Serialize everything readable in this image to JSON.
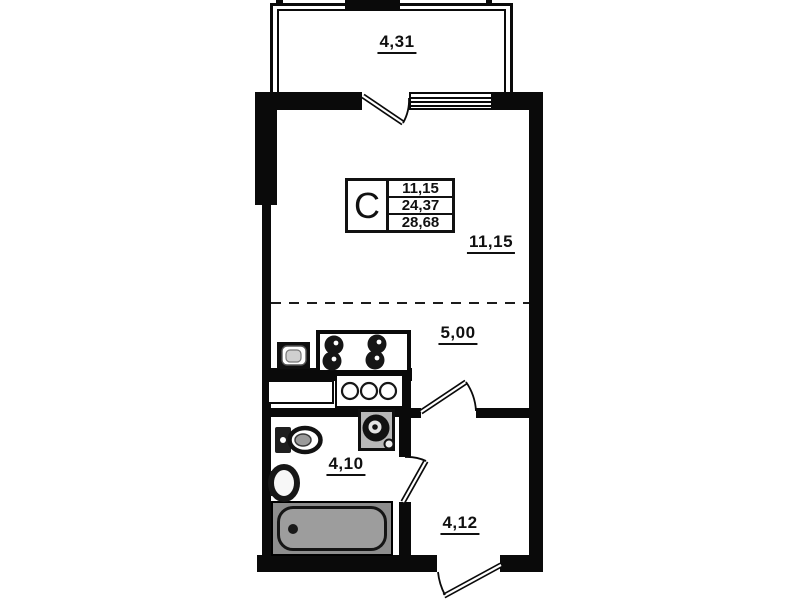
{
  "unit_box": {
    "type_label": "С",
    "rows": [
      "11,15",
      "24,37",
      "28,68"
    ]
  },
  "room_labels": {
    "balcony": "4,31",
    "living": "11,15",
    "kitchen": "5,00",
    "bathroom": "4,10",
    "hallway": "4,12"
  },
  "icons": {
    "stove": "stove-four-burners-icon",
    "kitchen_sink": "kitchen-sink-icon",
    "counter": "kitchen-counter-icon",
    "counter_circles": "counter-three-circles-icon",
    "washbasin": "washbasin-icon",
    "toilet": "toilet-icon",
    "corner_sink": "corner-sink-icon",
    "bathtub": "bathtub-icon",
    "window": "window-icon",
    "doors": "door-swing-icon",
    "zone_divider": "dashed-zone-divider"
  },
  "colors": {
    "wall": "#0a0a0a",
    "background": "#ffffff",
    "bathtub_outer": "#8d8d8d",
    "bathtub_inner": "#9d9d9d",
    "washbasin_gray": "#b8b8b8",
    "toilet_inner": "#9a9a9a"
  }
}
